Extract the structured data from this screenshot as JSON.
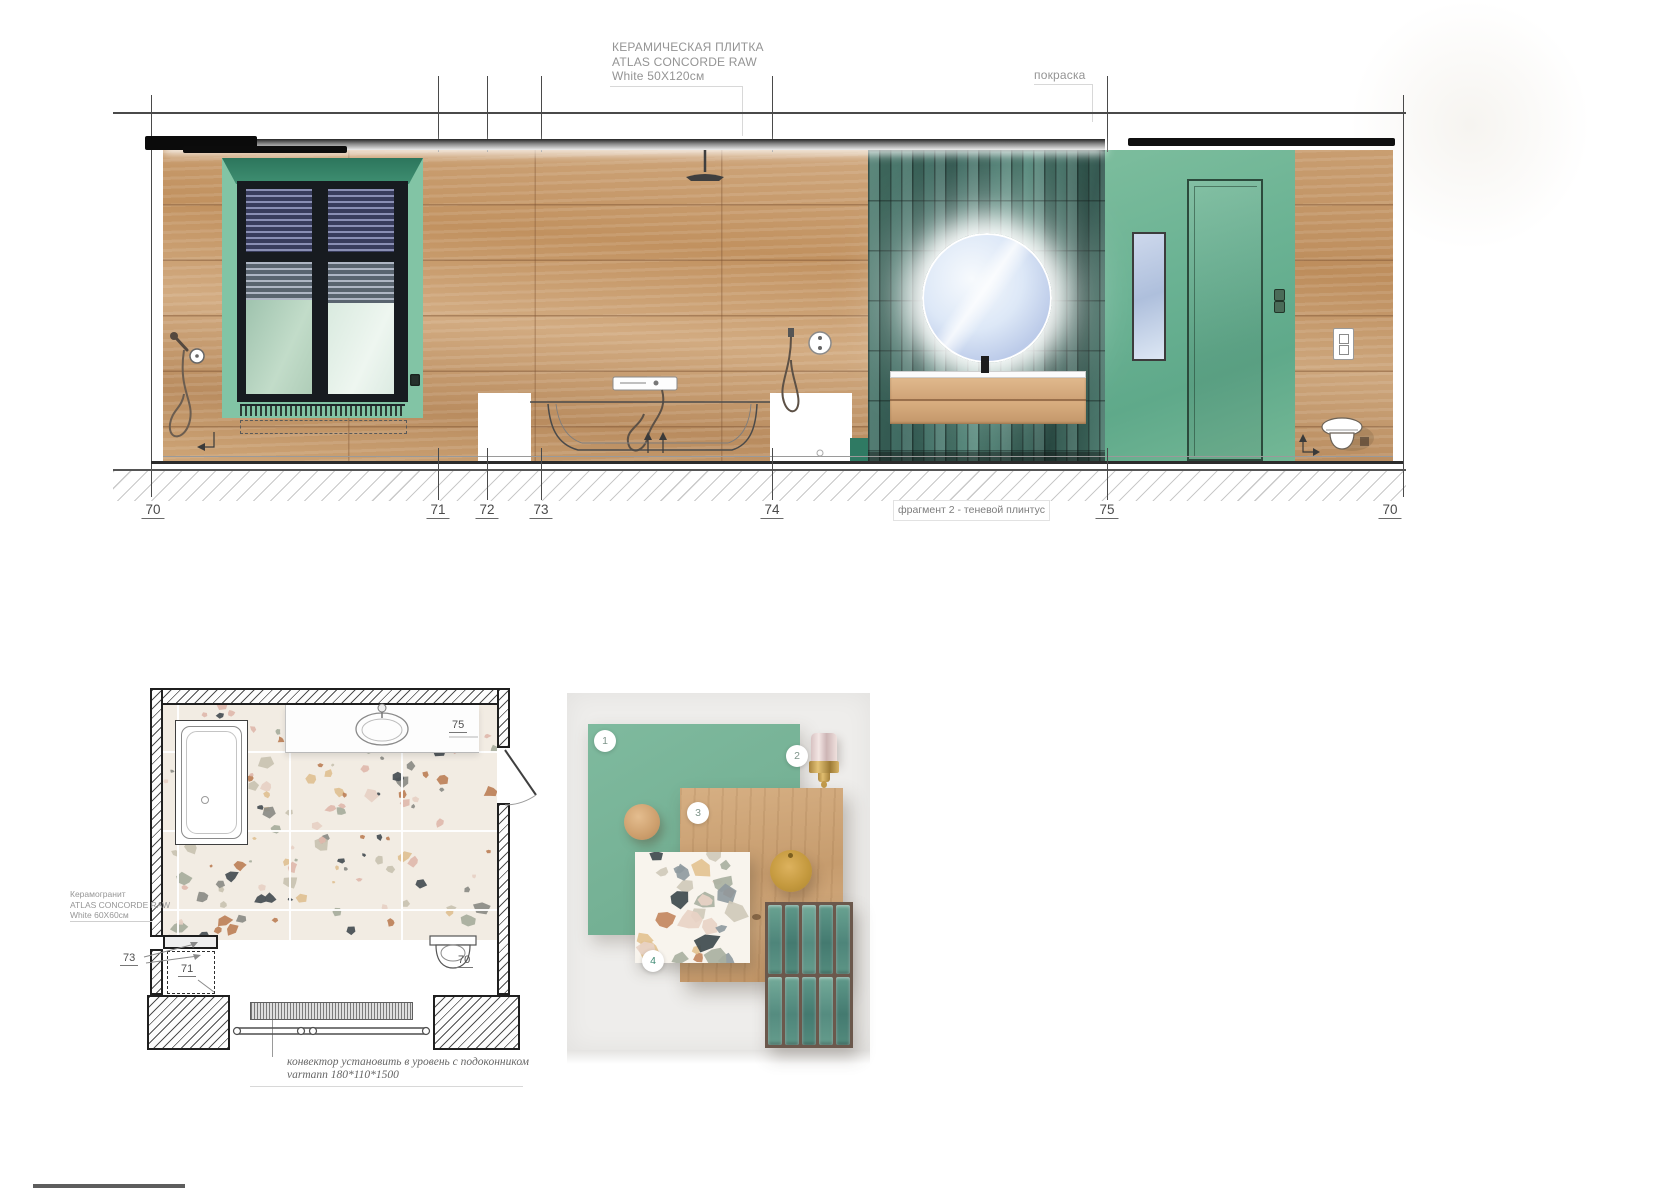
{
  "elevation": {
    "tile_label": {
      "line1": "КЕРАМИЧЕСКАЯ ПЛИТКА",
      "line2": "ATLAS CONCORDE RAW",
      "line3": "White 50X120см"
    },
    "paint_label": "покраска",
    "fragment_label": "фрагмент 2 - теневой плинтус",
    "markers": [
      "70",
      "71",
      "72",
      "73",
      "74",
      "75",
      "70"
    ]
  },
  "plan": {
    "floor_label": {
      "line1": "Керамогранит",
      "line2": "ATLAS CONCORDE RAW",
      "line3": "White 60X60см"
    },
    "marker_75": "75",
    "marker_73": "73",
    "marker_71": "71",
    "marker_70": "70",
    "convector_note": {
      "line1": "конвектор установить в уровень с подоконником",
      "line2": "varmann 180*110*1500"
    }
  },
  "moodboard": {
    "badges": [
      "1",
      "2",
      "3",
      "4"
    ]
  },
  "colors": {
    "accent_green": "#74b496",
    "tile_teal": "#44786c",
    "wood": "#c89d74",
    "paint_green": "#6fb392"
  }
}
